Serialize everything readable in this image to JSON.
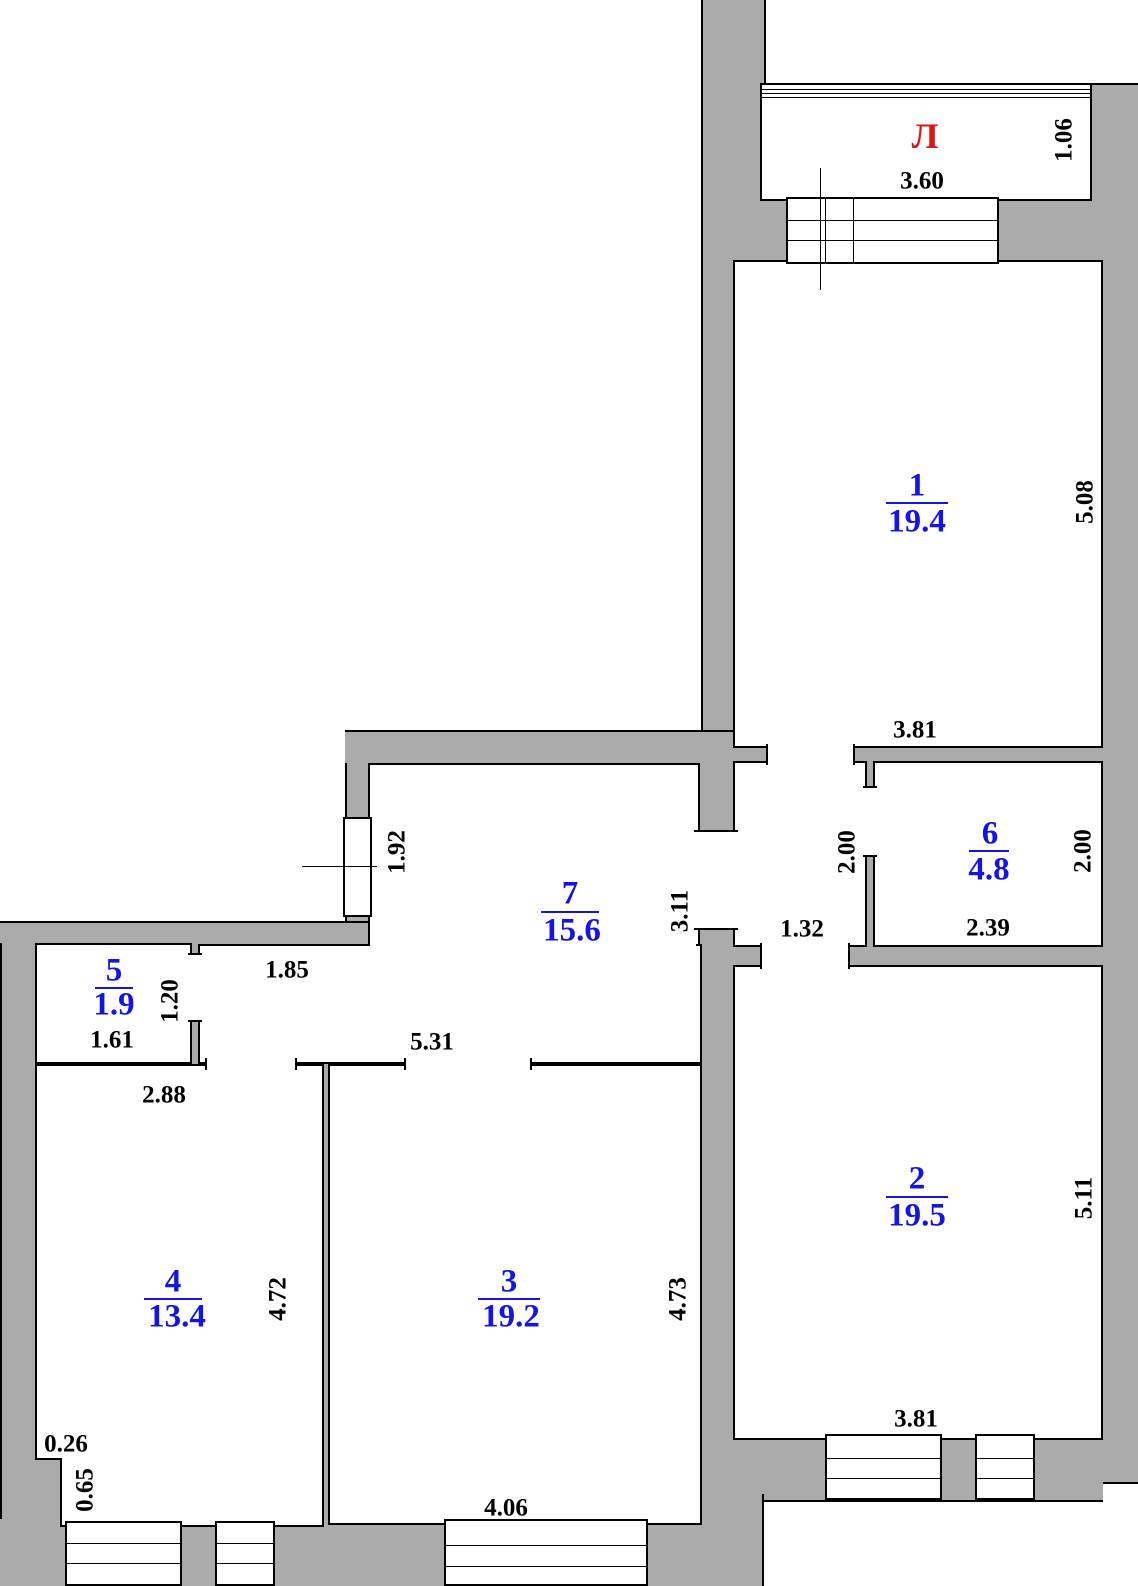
{
  "plan": {
    "balcony": {
      "label": "Л",
      "width": "3.60",
      "depth": "1.06"
    },
    "rooms": [
      {
        "number": "1",
        "area": "19.4",
        "width": "3.81",
        "height": "5.08"
      },
      {
        "number": "2",
        "area": "19.5",
        "width": "3.81",
        "height": "5.11"
      },
      {
        "number": "3",
        "area": "19.2",
        "width": "4.06",
        "height": "4.73"
      },
      {
        "number": "4",
        "area": "13.4",
        "top_width": "2.88",
        "height": "4.72",
        "notch_width": "0.26",
        "notch_height": "0.65"
      },
      {
        "number": "5",
        "area": "1.9",
        "width": "1.61",
        "height": "1.20"
      },
      {
        "number": "6",
        "area": "4.8",
        "width": "2.39",
        "height": "2.00"
      },
      {
        "number": "7",
        "area": "15.6",
        "bottom_width": "5.31",
        "height": "3.11",
        "window": "1.92",
        "nook_width": "1.85"
      }
    ],
    "hall": {
      "width": "1.32",
      "height": "2.00"
    },
    "colors": {
      "wall_fill": "#ababab",
      "outline": "#000000",
      "room_label": "#1414e6",
      "balcony_label": "#dd1414",
      "dim_text": "#000000",
      "background": "#ffffff"
    }
  }
}
